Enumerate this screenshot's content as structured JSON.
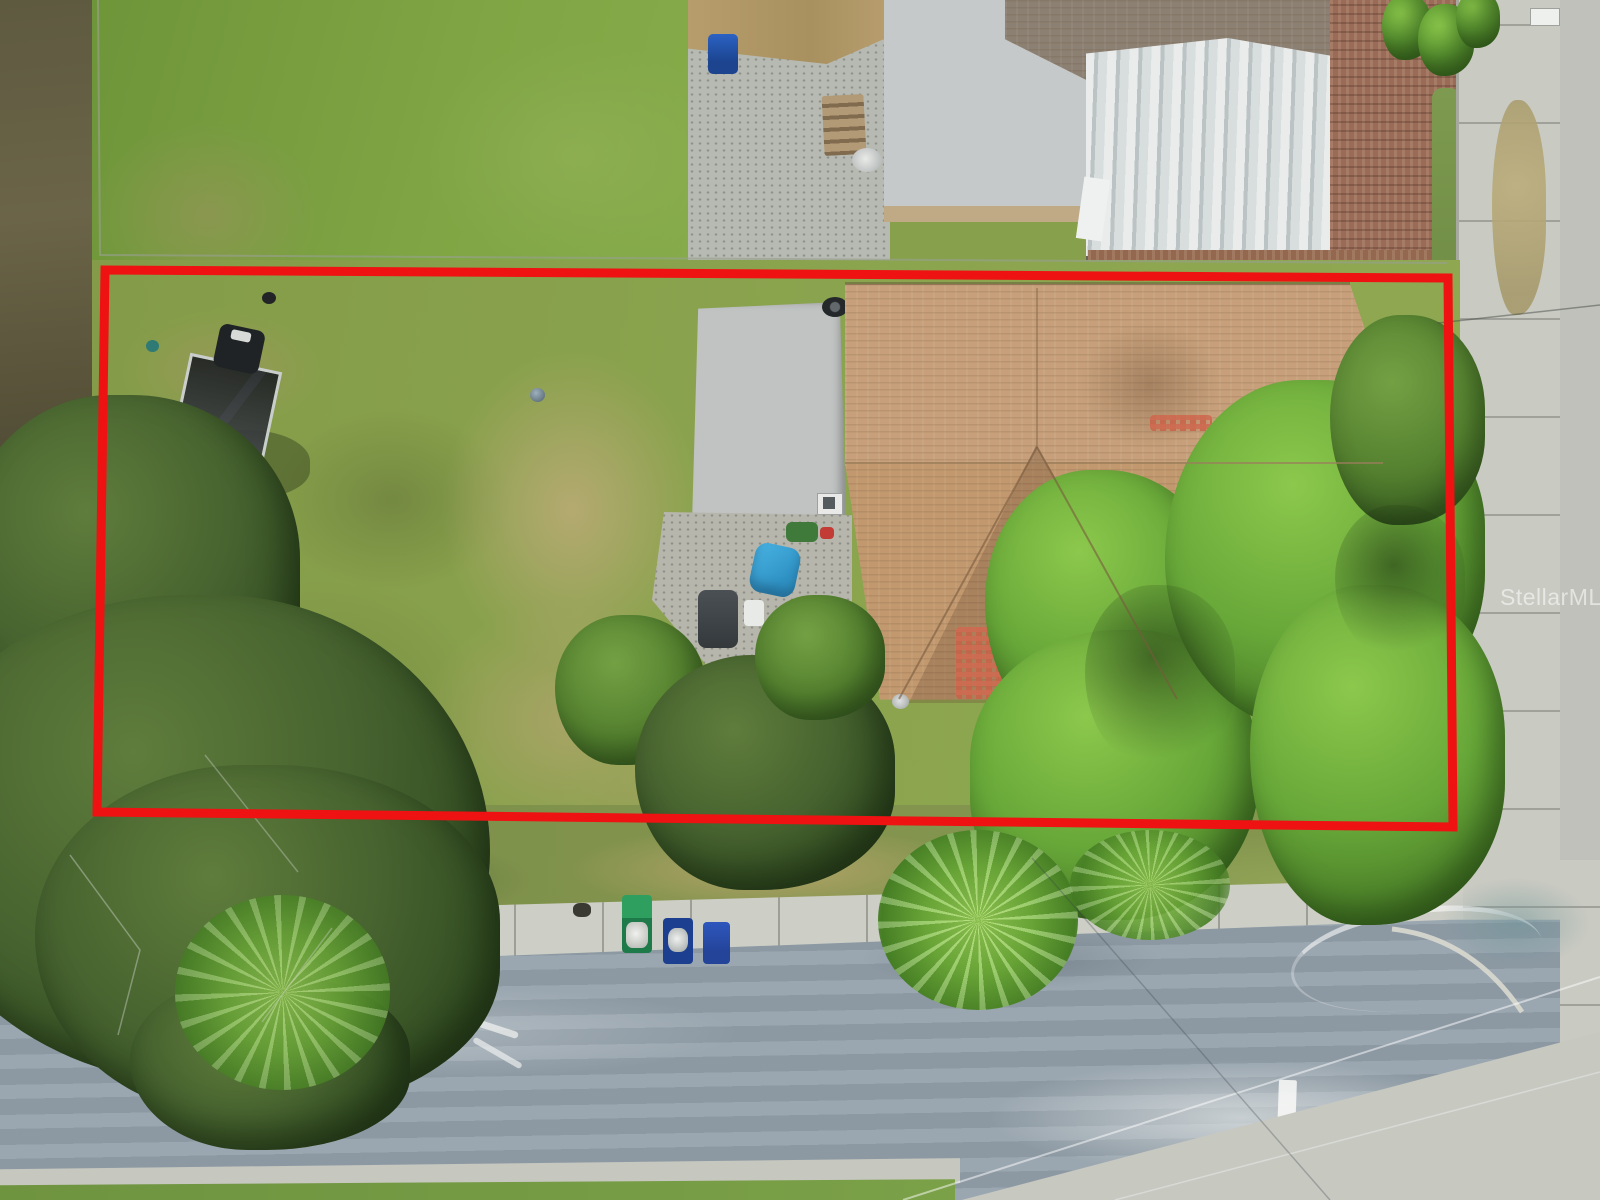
{
  "meta": {
    "type": "aerial-drone-photo",
    "subject": "top-down view of a residential parcel with house, lawn, trees and street, outlined in red"
  },
  "watermark": {
    "text": "StellarMLS"
  },
  "annotation": {
    "label": "parcel-boundary",
    "shape": "rectangle",
    "color": "#ee1212",
    "stroke_px": 9
  },
  "colors": {
    "boundary_red": "#ee1212",
    "lawn_green": "#87a04b",
    "roof_shingle_tan": "#c7a07b",
    "carport_roof_gray": "#c0c3c2",
    "asphalt_blue_gray": "#93a0aa",
    "concrete_light": "#cdcec6",
    "tree_dark_green": "#47632f",
    "tree_bright_green": "#68a839",
    "brick_courtyard": "#9a6c57"
  },
  "scene": {
    "elements": [
      "neighbor-back-lawn",
      "dirt-alley-strip",
      "chain-link-fence",
      "neighbor-concrete-patio",
      "neighbor-wood-fence",
      "neighbor-blue-trash-bin",
      "neighbor-wood-steps",
      "neighbor-satellite-dish",
      "neighbor-flat-roof-building",
      "neighbor-dark-shingle-roof",
      "neighbor-metal-roof-shed",
      "brick-paved-courtyard",
      "hedge-row",
      "street-sidewalk-right",
      "cross-street-right",
      "subject-lot-lawn",
      "sandy-footpath",
      "boat-trailer-with-outboard-motor",
      "main-house-shingle-roof",
      "replaced-shingle-patches",
      "carport-flat-roof",
      "roof-skylight",
      "spare-tire",
      "rear-patio",
      "blue-lawn-chair",
      "barbecue-grill",
      "cooler",
      "oak-tree-canopy",
      "palm-trees",
      "bright-tree-canopy",
      "scrub-strip-dried-palm-fronds",
      "green-trash-bin-open",
      "blue-trash-bin-open",
      "blue-trash-bin-closed",
      "front-sidewalk",
      "asphalt-road",
      "worn-road-paint",
      "stop-bar-marking",
      "south-curb-and-grass",
      "concrete-intersection-apron",
      "overhead-power-lines",
      "parcel-boundary-outline",
      "stellar-mls-watermark"
    ]
  }
}
